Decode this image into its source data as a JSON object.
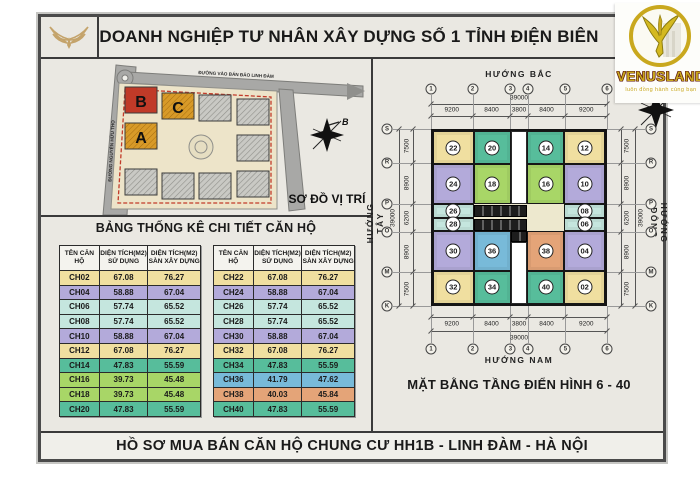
{
  "header": {
    "title": "DOANH NGHIỆP TƯ NHÂN XÂY DỰNG SỐ 1 TỈNH ĐIỆN BIÊN"
  },
  "logo": {
    "brand": "VENUSLAND",
    "tagline": "luôn đồng hành cùng bạn"
  },
  "site_map": {
    "title": "SƠ ĐỒ VỊ TRÍ",
    "road_top": "ĐƯỜNG VÀO BÁN ĐẢO LINH ĐÀM",
    "road_left": "ĐƯỜNG NGUYỄN HỮU THỌ",
    "compass_label": "B",
    "blocks": [
      "B",
      "C",
      "A"
    ]
  },
  "table_section": {
    "title": "BẢNG THỐNG KÊ CHI TIẾT CĂN HỘ",
    "headers": {
      "name": "TÊN CĂN HỘ",
      "area1_l1": "DIỆN TÍCH(M2)",
      "area1_l2": "SỬ DỤNG",
      "area2_l1": "DIỆN TÍCH(M2)",
      "area2_l2": "SÀN XÂY DỰNG"
    },
    "left_rows": [
      {
        "name": "CH02",
        "use": "67.08",
        "floor": "76.27",
        "color": "yellow"
      },
      {
        "name": "CH04",
        "use": "58.88",
        "floor": "67.04",
        "color": "purple"
      },
      {
        "name": "CH06",
        "use": "57.74",
        "floor": "65.52",
        "color": "cyan"
      },
      {
        "name": "CH08",
        "use": "57.74",
        "floor": "65.52",
        "color": "cyan"
      },
      {
        "name": "CH10",
        "use": "58.88",
        "floor": "67.04",
        "color": "purple"
      },
      {
        "name": "CH12",
        "use": "67.08",
        "floor": "76.27",
        "color": "yellow"
      },
      {
        "name": "CH14",
        "use": "47.83",
        "floor": "55.59",
        "color": "teal"
      },
      {
        "name": "CH16",
        "use": "39.73",
        "floor": "45.48",
        "color": "green"
      },
      {
        "name": "CH18",
        "use": "39.73",
        "floor": "45.48",
        "color": "green"
      },
      {
        "name": "CH20",
        "use": "47.83",
        "floor": "55.59",
        "color": "teal"
      }
    ],
    "right_rows": [
      {
        "name": "CH22",
        "use": "67.08",
        "floor": "76.27",
        "color": "yellow"
      },
      {
        "name": "CH24",
        "use": "58.88",
        "floor": "67.04",
        "color": "purple"
      },
      {
        "name": "CH26",
        "use": "57.74",
        "floor": "65.52",
        "color": "cyan"
      },
      {
        "name": "CH28",
        "use": "57.74",
        "floor": "65.52",
        "color": "cyan"
      },
      {
        "name": "CH30",
        "use": "58.88",
        "floor": "67.04",
        "color": "purple"
      },
      {
        "name": "CH32",
        "use": "67.08",
        "floor": "76.27",
        "color": "yellow"
      },
      {
        "name": "CH34",
        "use": "47.83",
        "floor": "55.59",
        "color": "teal"
      },
      {
        "name": "CH36",
        "use": "41.79",
        "floor": "47.62",
        "color": "blue"
      },
      {
        "name": "CH38",
        "use": "40.03",
        "floor": "45.84",
        "color": "orange"
      },
      {
        "name": "CH40",
        "use": "47.83",
        "floor": "55.59",
        "color": "teal"
      }
    ]
  },
  "floor_plan": {
    "title": "MẶT BẰNG TẦNG ĐIỂN HÌNH 6 - 40",
    "directions": {
      "north": "HƯỚNG BẮC",
      "south": "HƯỚNG NAM",
      "west": "HƯỚNG TÂY",
      "east": "HƯỚNG ĐÔNG"
    },
    "grid_cols": [
      "1",
      "2",
      "3",
      "4",
      "5",
      "6"
    ],
    "grid_rows": [
      "S",
      "R",
      "P",
      "O",
      "M",
      "K"
    ],
    "dims_h": [
      "9200",
      "8400",
      "3800",
      "8400",
      "9200"
    ],
    "dims_v": [
      "7500",
      "8900",
      "6200",
      "8900",
      "7500"
    ],
    "total_dim": "39000",
    "units": [
      {
        "id": "22",
        "color": "yellow"
      },
      {
        "id": "20",
        "color": "teal"
      },
      {
        "id": "14",
        "color": "teal"
      },
      {
        "id": "12",
        "color": "yellow"
      },
      {
        "id": "24",
        "color": "purple"
      },
      {
        "id": "18",
        "color": "green"
      },
      {
        "id": "16",
        "color": "green"
      },
      {
        "id": "10",
        "color": "purple"
      },
      {
        "id": "26",
        "color": "cyan"
      },
      {
        "id": "08",
        "color": "cyan"
      },
      {
        "id": "28",
        "color": "cyan"
      },
      {
        "id": "06",
        "color": "cyan"
      },
      {
        "id": "30",
        "color": "purple"
      },
      {
        "id": "36",
        "color": "blue"
      },
      {
        "id": "38",
        "color": "orange"
      },
      {
        "id": "04",
        "color": "purple"
      },
      {
        "id": "32",
        "color": "yellow"
      },
      {
        "id": "34",
        "color": "teal"
      },
      {
        "id": "40",
        "color": "teal"
      },
      {
        "id": "02",
        "color": "yellow"
      }
    ],
    "palette": {
      "yellow": "#F0DFA0",
      "purple": "#B3AADA",
      "cyan": "#C5E6DE",
      "teal": "#57BD9B",
      "green": "#A8D667",
      "blue": "#78BAD9",
      "orange": "#E4A478",
      "block_red": "#C03A28",
      "block_orange": "#D89A28"
    }
  },
  "footer": {
    "text": "HỒ SƠ MUA BÁN CĂN HỘ CHUNG CƯ HH1B  - LINH ĐÀM - HÀ NỘI"
  }
}
